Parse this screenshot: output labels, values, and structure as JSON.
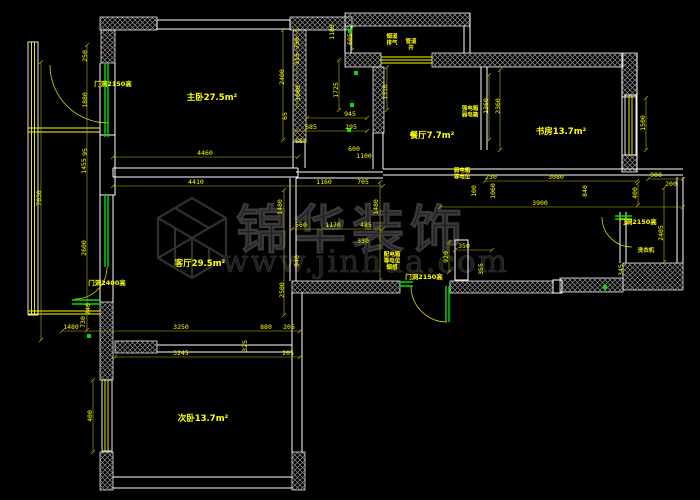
{
  "drawing": {
    "type": "cad-floor-plan",
    "background": "#000000",
    "colors": {
      "walls": "#ffffff",
      "dimensions": "#ffff00",
      "doors": "#00e000",
      "watermark": "#1e1e1e"
    },
    "watermark": {
      "logo": "cube-logo",
      "title": "锦华装饰",
      "url": "www.jinhua.com"
    },
    "room_labels": [
      {
        "text": "主卧27.5m²",
        "x": 212,
        "y": 100
      },
      {
        "text": "客厅29.5m²",
        "x": 200,
        "y": 266
      },
      {
        "text": "次卧13.7m²",
        "x": 203,
        "y": 421
      },
      {
        "text": "餐厅7.7m²",
        "x": 432,
        "y": 138
      },
      {
        "text": "书房13.7m²",
        "x": 561,
        "y": 134
      }
    ],
    "door_labels": [
      {
        "text": "门洞2150高",
        "x": 113,
        "y": 86
      },
      {
        "text": "门洞2400高",
        "x": 107,
        "y": 285
      },
      {
        "text": "门洞2150高",
        "x": 424,
        "y": 279
      },
      {
        "text": "门洞2150高",
        "x": 638,
        "y": 224
      }
    ],
    "annotations": [
      {
        "lines": [
          "烟道",
          "排气"
        ],
        "x": 392,
        "y": 38
      },
      {
        "lines": [
          "管道",
          "井"
        ],
        "x": 411,
        "y": 43
      },
      {
        "lines": [
          "强电箱",
          "弱电箱"
        ],
        "x": 470,
        "y": 110
      },
      {
        "lines": [
          "弱电箱",
          "等电位"
        ],
        "x": 462,
        "y": 172
      },
      {
        "lines": [
          "配电箱",
          "等电位",
          "烟感"
        ],
        "x": 392,
        "y": 256
      },
      {
        "lines": [
          "洗衣机"
        ],
        "x": 646,
        "y": 252
      }
    ],
    "dimensions": [
      {
        "v": "7030",
        "x": 41,
        "y": 198,
        "r": -90
      },
      {
        "v": "1455",
        "x": 86,
        "y": 166,
        "r": -90
      },
      {
        "v": "2600",
        "x": 86,
        "y": 248,
        "r": -90
      },
      {
        "v": "250",
        "x": 87,
        "y": 56,
        "r": -90
      },
      {
        "v": "1880",
        "x": 87,
        "y": 100,
        "r": -90
      },
      {
        "v": "95",
        "x": 87,
        "y": 152,
        "r": -90
      },
      {
        "v": "240",
        "x": 90,
        "y": 309,
        "r": -90
      },
      {
        "v": "730",
        "x": 85,
        "y": 322,
        "r": -90
      },
      {
        "v": "1480",
        "x": 71,
        "y": 329,
        "r": 0
      },
      {
        "v": "400",
        "x": 92,
        "y": 416,
        "r": -90
      },
      {
        "v": "2400",
        "x": 284,
        "y": 77,
        "r": -90
      },
      {
        "v": "730",
        "x": 299,
        "y": 43,
        "r": -90
      },
      {
        "v": "115",
        "x": 299,
        "y": 59,
        "r": -90
      },
      {
        "v": "1680",
        "x": 300,
        "y": 93,
        "r": -90
      },
      {
        "v": "65",
        "x": 287,
        "y": 116,
        "r": -90
      },
      {
        "v": "605",
        "x": 352,
        "y": 39,
        "r": -90
      },
      {
        "v": "1180",
        "x": 334,
        "y": 32,
        "r": -90
      },
      {
        "v": "1725",
        "x": 338,
        "y": 90,
        "r": -90
      },
      {
        "v": "1510",
        "x": 387,
        "y": 92,
        "r": -90
      },
      {
        "v": "945",
        "x": 350,
        "y": 116,
        "r": 0
      },
      {
        "v": "685",
        "x": 311,
        "y": 129,
        "r": 0
      },
      {
        "v": "295",
        "x": 351,
        "y": 129,
        "r": 0
      },
      {
        "v": "880",
        "x": 301,
        "y": 143,
        "r": 0
      },
      {
        "v": "600",
        "x": 354,
        "y": 151,
        "r": 0
      },
      {
        "v": "1100",
        "x": 364,
        "y": 158,
        "r": 0
      },
      {
        "v": "4460",
        "x": 205,
        "y": 155,
        "r": 0
      },
      {
        "v": "4410",
        "x": 196,
        "y": 184,
        "r": 0
      },
      {
        "v": "1160",
        "x": 324,
        "y": 184,
        "r": 0
      },
      {
        "v": "705",
        "x": 363,
        "y": 184,
        "r": 0
      },
      {
        "v": "560",
        "x": 301,
        "y": 227,
        "r": 0
      },
      {
        "v": "1170",
        "x": 333,
        "y": 227,
        "r": 0
      },
      {
        "v": "485",
        "x": 366,
        "y": 227,
        "r": 0
      },
      {
        "v": "330",
        "x": 363,
        "y": 243,
        "r": 0
      },
      {
        "v": "940",
        "x": 299,
        "y": 261,
        "r": -90
      },
      {
        "v": "2500",
        "x": 284,
        "y": 290,
        "r": -90
      },
      {
        "v": "1480",
        "x": 282,
        "y": 207,
        "r": -90
      },
      {
        "v": "1480",
        "x": 378,
        "y": 207,
        "r": -90
      },
      {
        "v": "920",
        "x": 448,
        "y": 257,
        "r": -90
      },
      {
        "v": "350",
        "x": 464,
        "y": 248,
        "r": 0
      },
      {
        "v": "355",
        "x": 483,
        "y": 269,
        "r": -90
      },
      {
        "v": "1360",
        "x": 488,
        "y": 106,
        "r": -90
      },
      {
        "v": "2360",
        "x": 500,
        "y": 106,
        "r": -90
      },
      {
        "v": "230",
        "x": 491,
        "y": 179,
        "r": 0
      },
      {
        "v": "3080",
        "x": 556,
        "y": 179,
        "r": 0
      },
      {
        "v": "100",
        "x": 476,
        "y": 191,
        "r": -90
      },
      {
        "v": "1060",
        "x": 495,
        "y": 191,
        "r": -90
      },
      {
        "v": "3900",
        "x": 540,
        "y": 205,
        "r": 0
      },
      {
        "v": "900",
        "x": 656,
        "y": 177,
        "r": 0
      },
      {
        "v": "200",
        "x": 671,
        "y": 186,
        "r": 0
      },
      {
        "v": "400",
        "x": 637,
        "y": 193,
        "r": -90
      },
      {
        "v": "840",
        "x": 587,
        "y": 191,
        "r": -90
      },
      {
        "v": "2405",
        "x": 663,
        "y": 233,
        "r": -90
      },
      {
        "v": "345",
        "x": 623,
        "y": 270,
        "r": -90
      },
      {
        "v": "1500",
        "x": 645,
        "y": 123,
        "r": -90
      },
      {
        "v": "3250",
        "x": 181,
        "y": 329,
        "r": 0
      },
      {
        "v": "880",
        "x": 266,
        "y": 329,
        "r": 0
      },
      {
        "v": "205",
        "x": 289,
        "y": 329,
        "r": 0
      },
      {
        "v": "3245",
        "x": 181,
        "y": 355,
        "r": 0
      },
      {
        "v": "205",
        "x": 288,
        "y": 355,
        "r": 0
      },
      {
        "v": "325",
        "x": 247,
        "y": 346,
        "r": -90
      }
    ]
  }
}
